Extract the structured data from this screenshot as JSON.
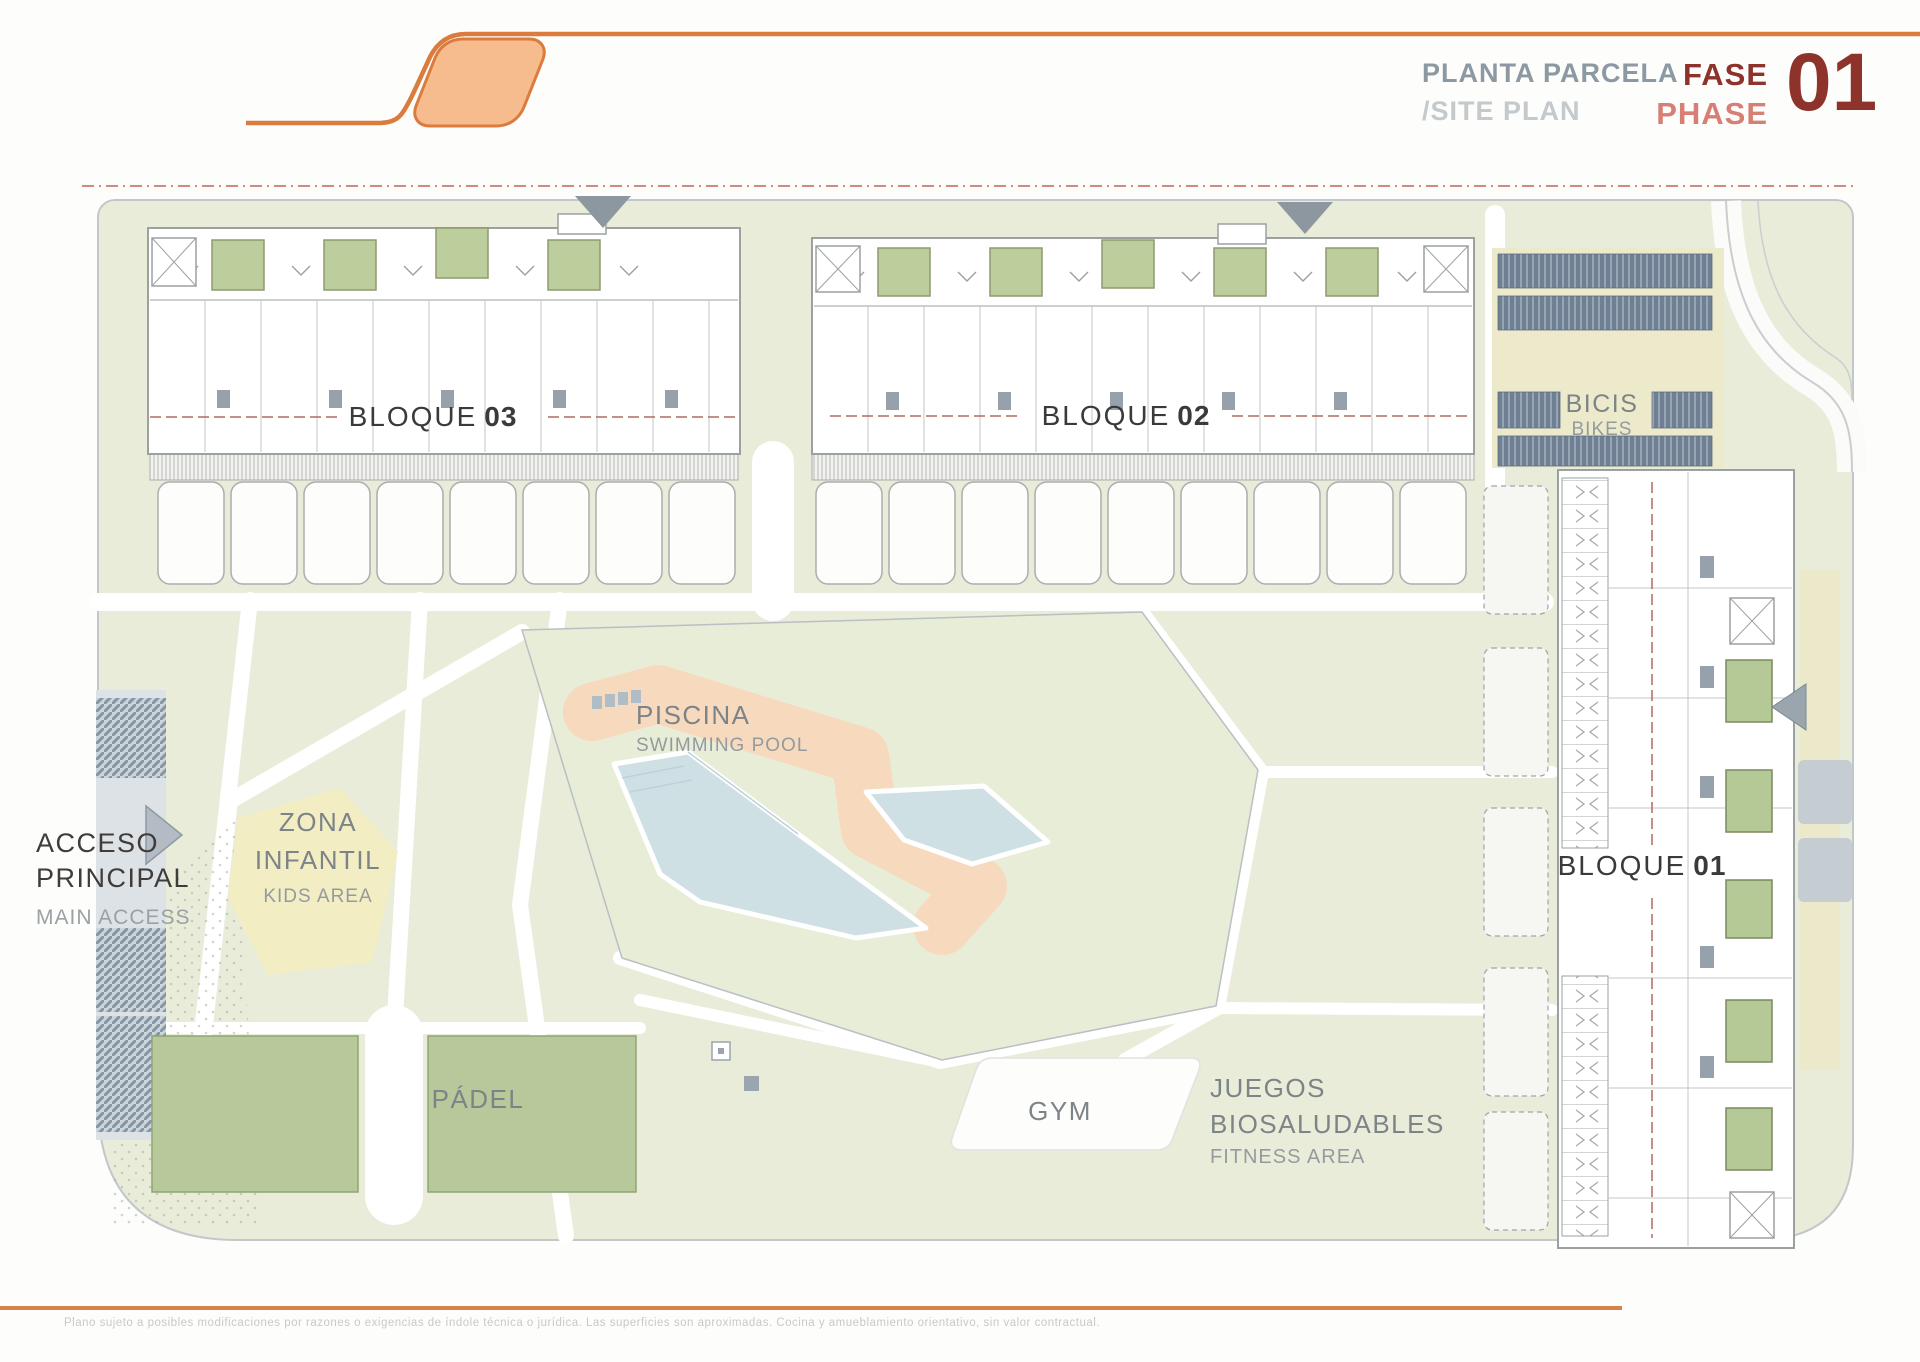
{
  "header": {
    "title_es": "PLANTA PARCELA",
    "title_en": "/SITE PLAN",
    "fase": "FASE",
    "phase": "PHASE",
    "number": "01"
  },
  "labels": {
    "bloque03": {
      "name": "BLOQUE",
      "num": "03"
    },
    "bloque02": {
      "name": "BLOQUE",
      "num": "02"
    },
    "bloque01": {
      "name": "BLOQUE",
      "num": "01"
    },
    "bikes": {
      "es": "BICIS",
      "en": "BIKES"
    },
    "pool": {
      "es": "PISCINA",
      "en": "SWIMMING POOL"
    },
    "kids": {
      "l1": "ZONA",
      "l2": "INFANTIL",
      "l3": "KIDS AREA"
    },
    "access": {
      "l1": "ACCESO",
      "l2": "PRINCIPAL",
      "l3": "MAIN ACCESS"
    },
    "padel": {
      "es": "PÁDEL"
    },
    "gym": {
      "es": "GYM"
    },
    "fitness": {
      "l1": "JUEGOS",
      "l2": "BIOSALUDABLES",
      "l3": "FITNESS AREA"
    }
  },
  "footer": {
    "disclaimer": "Plano sujeto a posibles modificaciones por razones o exigencias de índole técnica o jurídica. Las superficies son aproximadas. Cocina y amueblamiento orientativo, sin valor contractual."
  },
  "colors": {
    "accent_orange": "#db7b3e",
    "logo_fill": "#f6bc8e",
    "footer_orange": "#d9814a",
    "title_gray": "#8c98a2",
    "phase_dark": "#8e332b",
    "phase_light": "#d77f74",
    "plan_green": "#e9ecd9",
    "pool_blue": "#cfe0e4",
    "deck_peach": "#f7d9bd",
    "court_green": "#b7c89a",
    "patio_green": "#bcce9c",
    "bike_rack_blue": "#6f8094",
    "beige": "#ece9cb",
    "boundary_dash_red": "#c2665a"
  }
}
